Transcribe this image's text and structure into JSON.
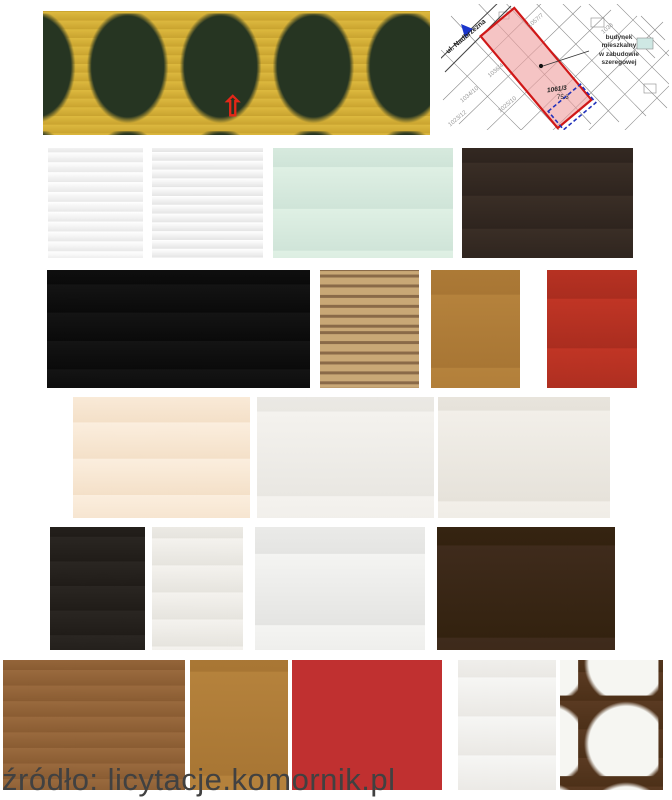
{
  "page": {
    "background": "#ffffff",
    "source_caption": "źródło: licytacje.komornik.pl"
  },
  "map": {
    "description": "Cadastral plot map with the property parcel highlighted in red",
    "street_label": "ul. Nadbrzeżna",
    "annotation_lines": [
      "budynek",
      "mieszkalny",
      "w zabudowie",
      "szeregowej"
    ],
    "parcel_label": "1061/3",
    "parcel_area": "75.3",
    "parcel_numbers": [
      "1036/4",
      "1034/10",
      "1025/10",
      "1023/12",
      "1057/7",
      "1038"
    ],
    "colors": {
      "parcel_fill": "#ef9f9f",
      "parcel_border": "#d01818",
      "marker_blue": "#1a35cc",
      "line_gray": "#8a8a8a"
    }
  },
  "photos": [
    {
      "name": "street-view",
      "description": "Row of terraced houses with red arrow marking the property"
    },
    {
      "name": "facade-front",
      "description": "Yellow house facade, front view"
    },
    {
      "name": "facade-side",
      "description": "Yellow terraced house with balcony under blue sky"
    },
    {
      "name": "kitchen-dark-cabinets",
      "description": "Kitchen with dark wood cabinets and terracotta tiled floor"
    },
    {
      "name": "living-dining-room",
      "description": "Bright living and dining room with wooden floor"
    },
    {
      "name": "living-room-tv",
      "description": "Living room with wall TV and brick fireplace"
    },
    {
      "name": "brick-staircase",
      "description": "Staircase with red brick wall"
    },
    {
      "name": "teal-hallway",
      "description": "Hallway with wooden door and teal walls"
    },
    {
      "name": "shower-bathroom",
      "description": "Bathroom with shower cabin and red bathrobe"
    },
    {
      "name": "sitting-room",
      "description": "Sitting room with dark red curtains and brown sofa"
    },
    {
      "name": "green-bedroom",
      "description": "Bedroom with green walls and pink bedspread"
    },
    {
      "name": "hallway-stairs",
      "description": "Hallway with brick chimney, staircase and pink wall"
    },
    {
      "name": "toilet-room",
      "description": "Toilet room with brown tiles"
    },
    {
      "name": "bathtub-washer",
      "description": "Bathroom with bathtub and washing machine"
    },
    {
      "name": "kitchen-fridge",
      "description": "Kitchen with refrigerator and pink walls"
    },
    {
      "name": "room-wardrobe",
      "description": "Room with dark wardrobe and wooden floor"
    },
    {
      "name": "attic-bedroom",
      "description": "Attic bedroom with two beds under sloped ceiling"
    },
    {
      "name": "orange-room",
      "description": "Room with orange wall and wooden door"
    },
    {
      "name": "dark-staircase",
      "description": "Dark wooden staircase seen from above"
    },
    {
      "name": "yellow-bathroom-toilet",
      "description": "Yellow bathroom with toilet and corner tub"
    },
    {
      "name": "yellow-bathroom-tub",
      "description": "Yellow bathroom with white corner bathtub"
    }
  ]
}
